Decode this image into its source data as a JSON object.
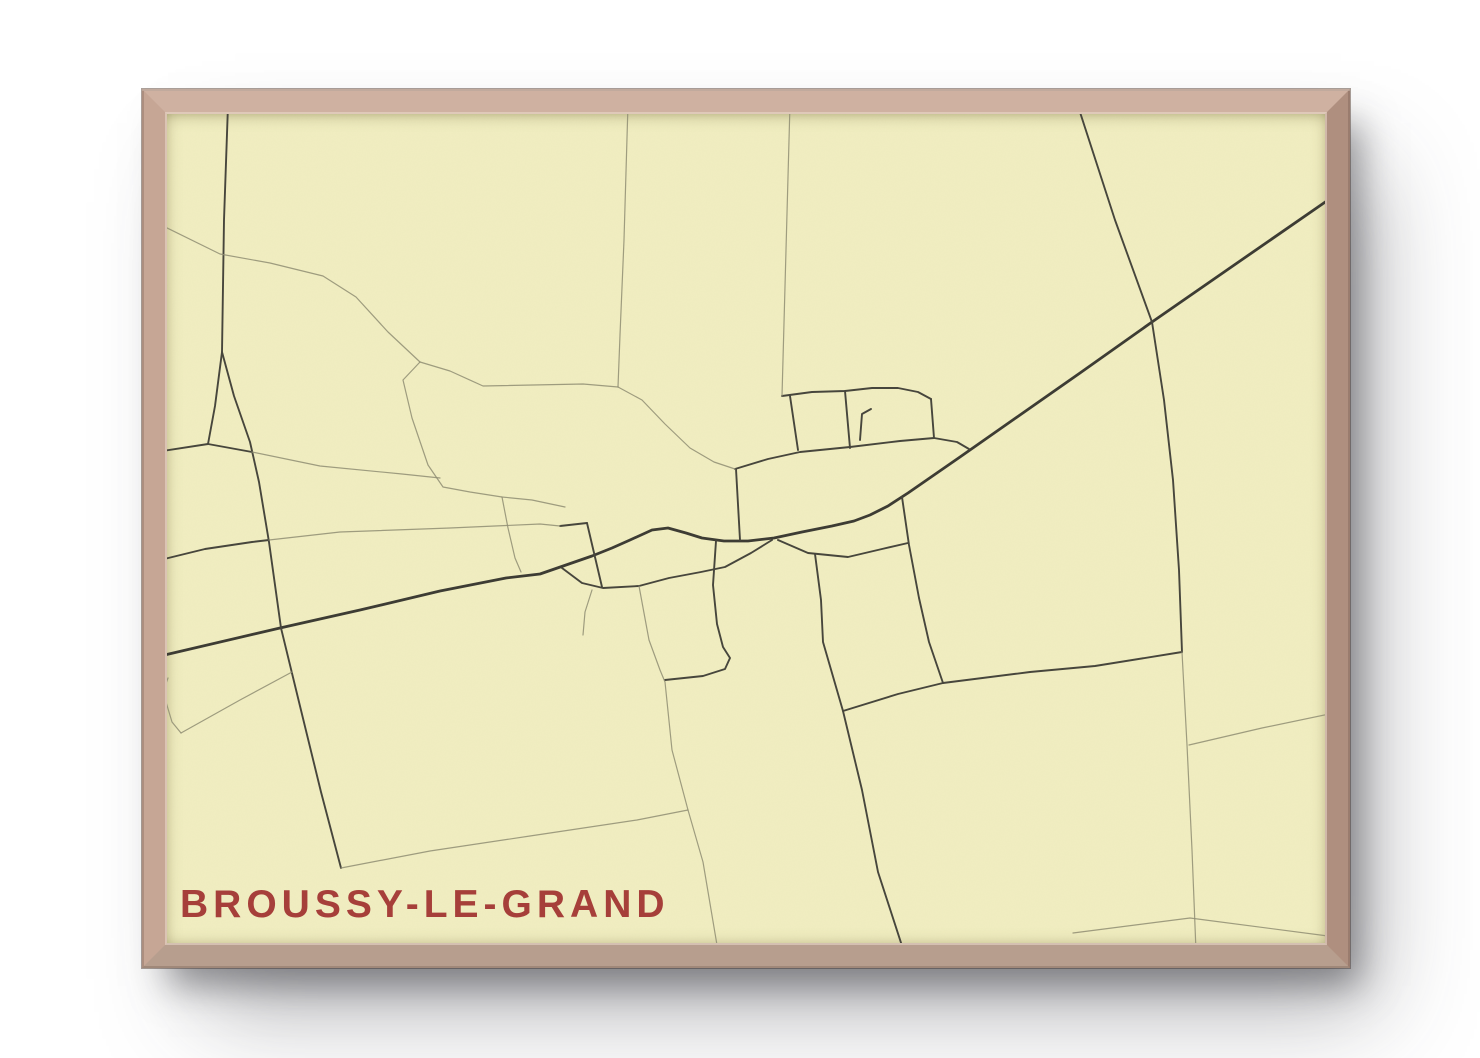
{
  "poster": {
    "title": "BROUSSY-LE-GRAND"
  },
  "theme": {
    "page_bg": "#ffffff",
    "paper": "#f1eec1",
    "title_color": "#a63f3a",
    "road_major": "#3c3b33",
    "road_medium": "#46453c",
    "road_faint": "#8f8d73",
    "frame_top": "#cfb1a1",
    "frame_left": "#c6a695",
    "frame_right": "#af8f7f",
    "frame_bottom": "#b79e8e"
  },
  "map": {
    "roads": [
      {
        "id": "main-road",
        "class": "major",
        "points": "156,657 280,628 360,610 440,591 506,578 540,574 566,565 592,556 612,548 630,540 652,530 668,528 686,533 702,538 724,541 748,541 774,538 802,532 832,526 854,521 870,515 888,506 908,493 960,457 1020,415 1080,373 1152,322 1240,261 1334,196"
      },
      {
        "id": "north-south-road-west",
        "class": "medium",
        "points": "228,105 224,220 222,352 234,396 250,442 259,482 269,542 281,628 299,702 321,792 341,868"
      },
      {
        "id": "fork-branch",
        "class": "medium",
        "points": "222,352 215,406 208,444"
      },
      {
        "id": "west-spur",
        "class": "medium",
        "points": "208,444 156,452"
      },
      {
        "id": "fork-connector",
        "class": "medium",
        "points": "208,444 252,452"
      },
      {
        "id": "west-road",
        "class": "medium",
        "points": "156,561 205,549 252,542 269,540"
      },
      {
        "id": "village-south-loop",
        "class": "medium",
        "points": "562,568 582,583 603,588 639,586 669,578 701,572 725,567 751,553 772,540"
      },
      {
        "id": "village-cross-street",
        "class": "medium",
        "points": "587,523 602,587"
      },
      {
        "id": "village-stub-west",
        "class": "medium",
        "points": "560,526 587,523"
      },
      {
        "id": "village-south-lane",
        "class": "medium",
        "points": "716,541 713,585 717,624 723,647 730,658 725,669 703,676 665,680"
      },
      {
        "id": "north-block-street",
        "class": "medium",
        "points": "782,396 812,392 845,391 872,388 898,388 918,392 931,399"
      },
      {
        "id": "block-lane-1",
        "class": "medium",
        "points": "790,396 798,450"
      },
      {
        "id": "block-lane-2",
        "class": "medium",
        "points": "845,391 850,448"
      },
      {
        "id": "block-lane-3",
        "class": "medium",
        "points": "931,399 934,438"
      },
      {
        "id": "upper-street",
        "class": "medium",
        "points": "735,469 768,459 800,452 850,447 900,441 934,438 957,442 969,449"
      },
      {
        "id": "upper-connector",
        "class": "medium",
        "points": "736,469 740,540"
      },
      {
        "id": "north-stub",
        "class": "medium",
        "points": "860,440 862,414 871,409"
      },
      {
        "id": "south-street",
        "class": "medium",
        "points": "778,540 808,553 848,557 882,549 908,543"
      },
      {
        "id": "southeast-road",
        "class": "medium",
        "points": "815,554 821,600 823,642 843,711 862,790 878,872 904,952"
      },
      {
        "id": "south-connector",
        "class": "medium",
        "points": "843,711 898,694 943,683"
      },
      {
        "id": "east-branch-road",
        "class": "medium",
        "points": "902,497 909,545 919,598 929,642 943,683"
      },
      {
        "id": "east-road",
        "class": "medium",
        "points": "943,683 1030,672 1095,666 1182,652"
      },
      {
        "id": "northeast-road",
        "class": "medium",
        "points": "1078,106 1115,220 1152,322 1164,400 1173,480 1179,570 1182,652"
      },
      {
        "id": "corner-road-south",
        "class": "faint",
        "points": "1182,652 1187,745 1192,850 1196,951"
      },
      {
        "id": "field-path-northwest",
        "class": "faint",
        "points": "157,223 220,254 270,263 323,276 356,297 388,332 420,362"
      },
      {
        "id": "field-loop-west",
        "class": "faint",
        "points": "420,362 403,380 412,418 428,465 443,487 470,492 502,497 532,500 565,507"
      },
      {
        "id": "field-path-mid",
        "class": "faint",
        "points": "252,452 320,466 402,474 440,478"
      },
      {
        "id": "parallel-lane",
        "class": "faint",
        "points": "269,540 340,532 450,528 540,524 560,526"
      },
      {
        "id": "field-vertical-1",
        "class": "faint",
        "points": "628,104 624,240 620,335 618,387"
      },
      {
        "id": "field-vertical-1-south",
        "class": "faint",
        "points": "618,387 642,400 665,424 690,448 714,462 735,469"
      },
      {
        "id": "field-cross-lane",
        "class": "faint",
        "points": "618,387 583,384 483,386 450,371 420,362"
      },
      {
        "id": "field-vertical-2",
        "class": "faint",
        "points": "790,104 786,250 782,396"
      },
      {
        "id": "field-lane-west",
        "class": "faint",
        "points": "502,497 508,528 515,558 521,572"
      },
      {
        "id": "field-path-east",
        "class": "faint",
        "points": "1189,745 1262,728 1334,713"
      },
      {
        "id": "field-path-southeast",
        "class": "faint",
        "points": "1073,933 1190,918 1328,936"
      },
      {
        "id": "south-field-lane",
        "class": "faint",
        "points": "639,586 649,640 660,670 665,682 672,750 688,810 703,862 718,951"
      },
      {
        "id": "south-diagonal-path",
        "class": "faint",
        "points": "341,868 430,851 530,836 637,820 688,810"
      },
      {
        "id": "southwest-hook",
        "class": "faint",
        "points": "168,678 163,692 172,722 181,733"
      },
      {
        "id": "southwest-path",
        "class": "faint",
        "points": "181,733 240,700 292,672"
      },
      {
        "id": "village-south-stub",
        "class": "faint",
        "points": "592,590 585,612 583,635"
      }
    ]
  }
}
